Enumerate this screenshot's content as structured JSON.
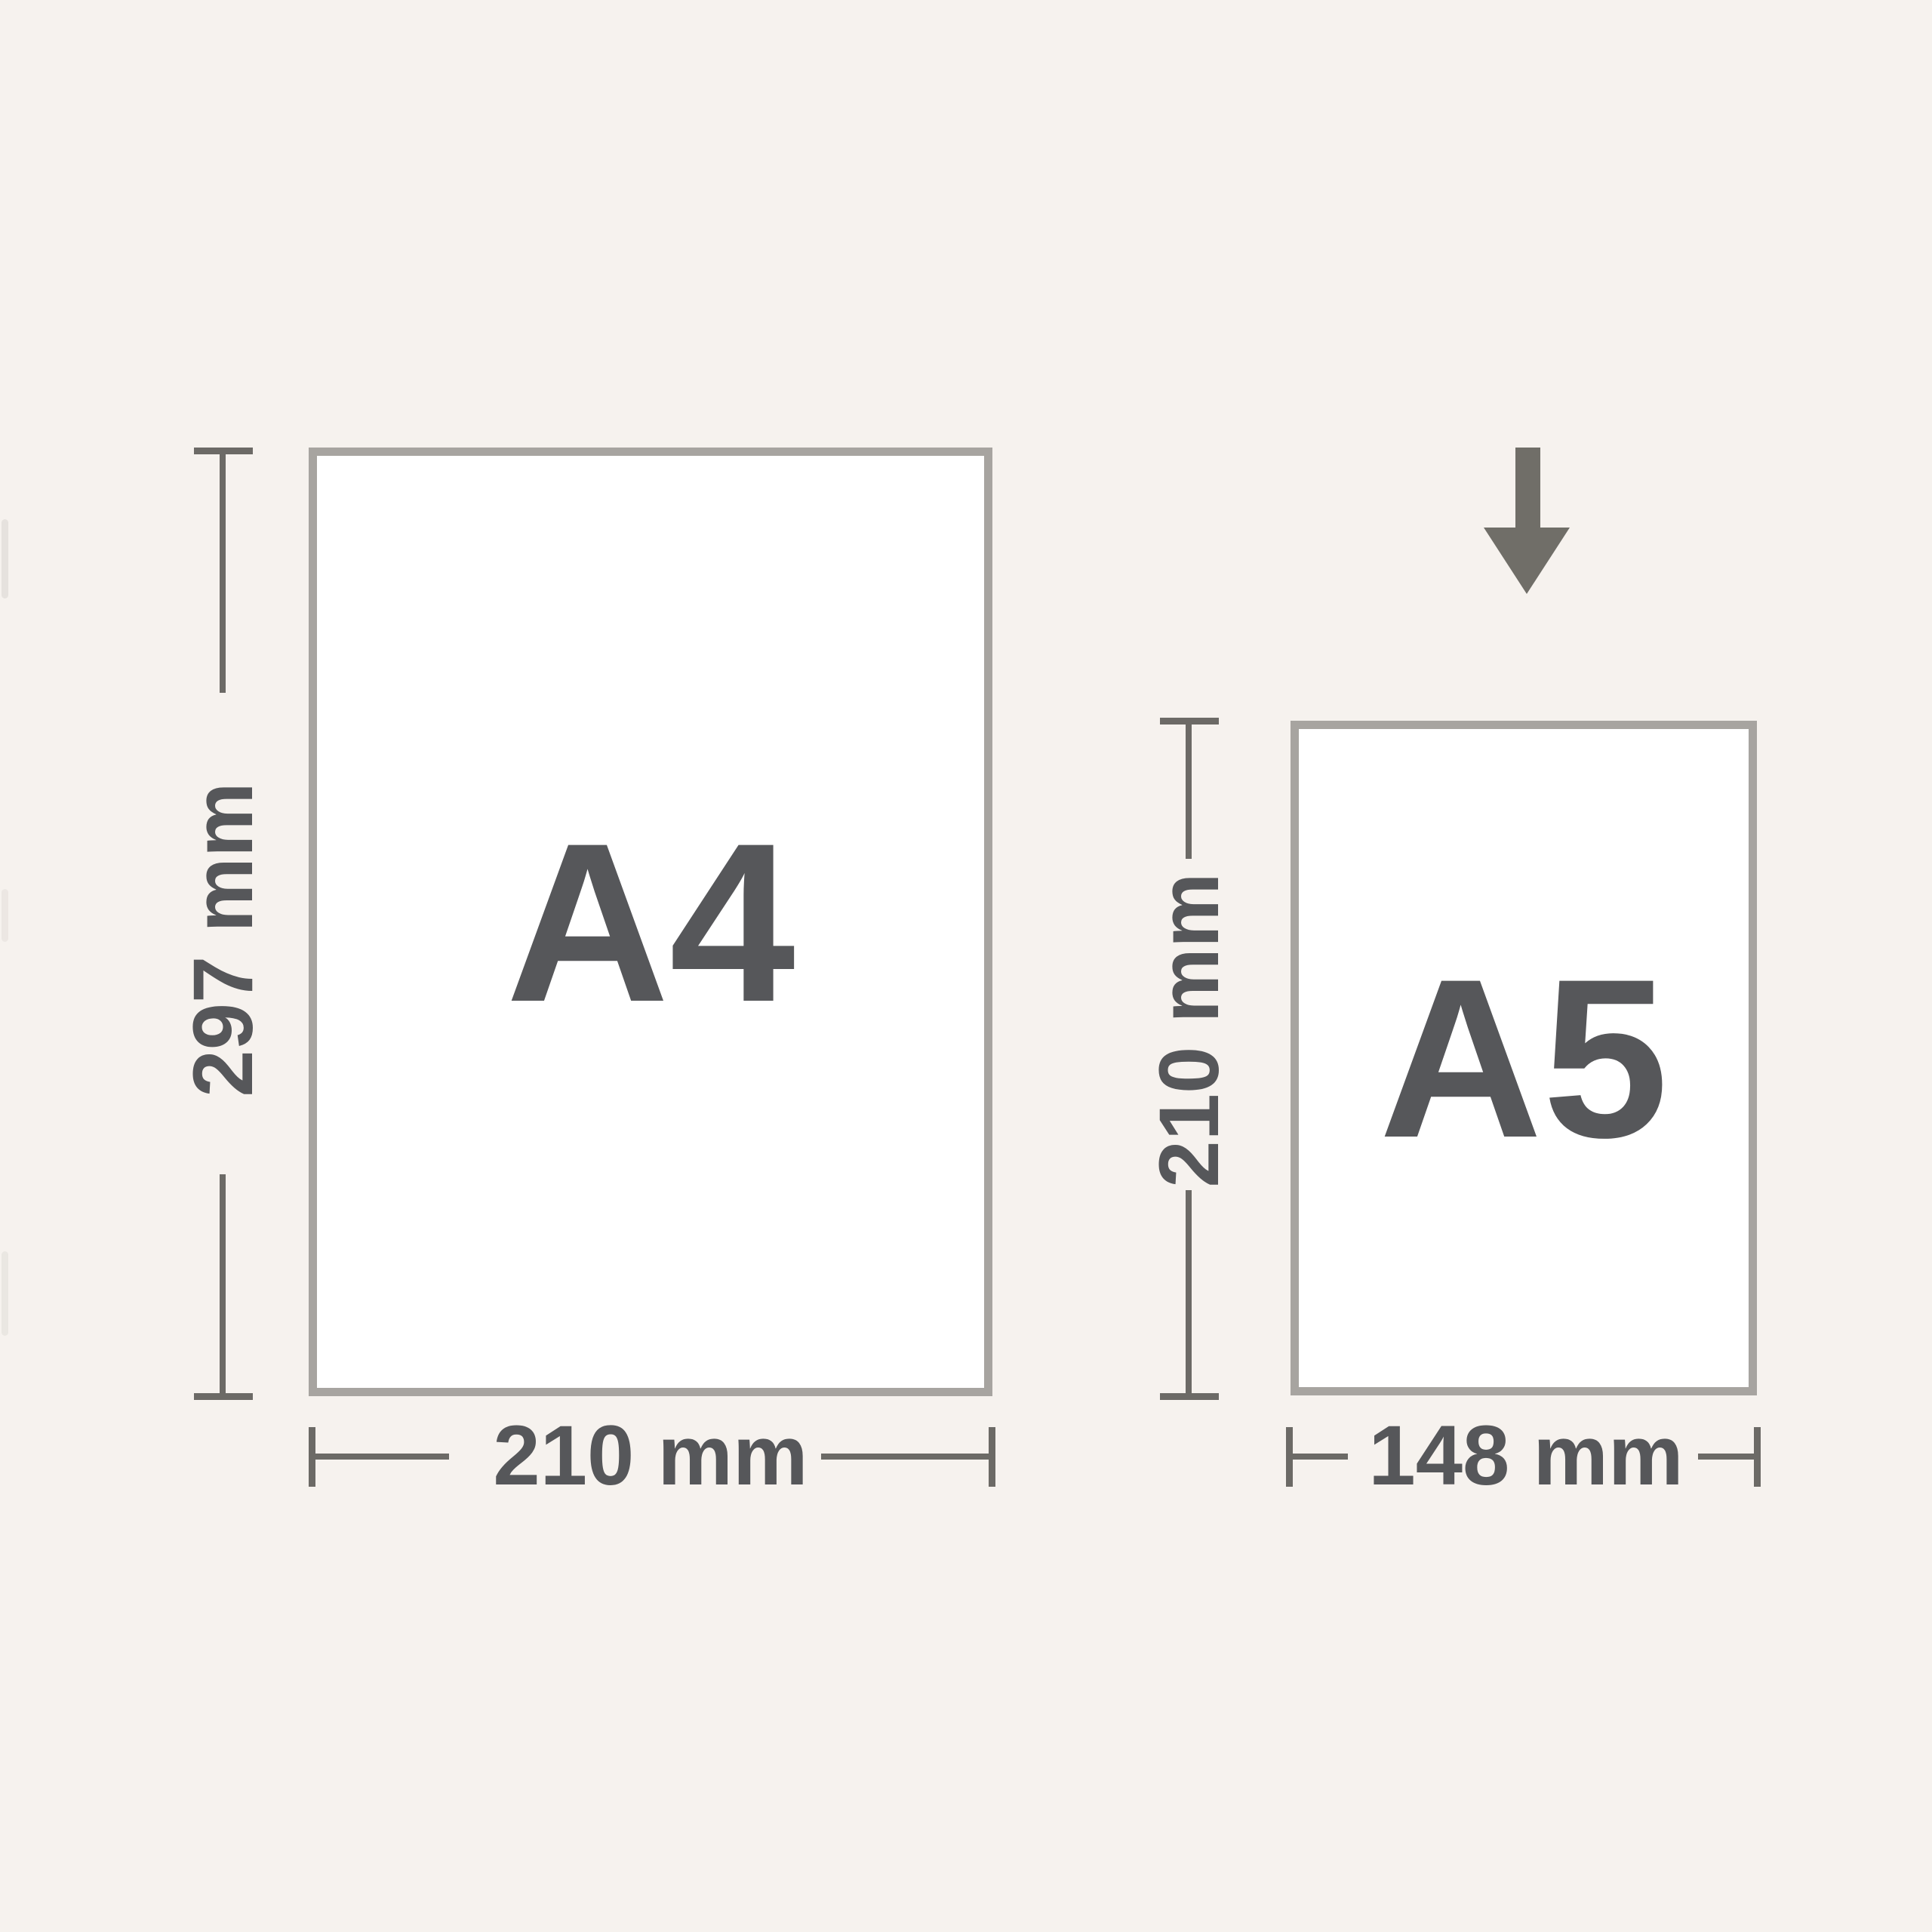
{
  "diagram": {
    "description": "Paper size comparison diagram showing A4 reduced to A5"
  },
  "papers": [
    {
      "name": "A4",
      "width_label": "210 mm",
      "height_label": "297 mm"
    },
    {
      "name": "A5",
      "width_label": "148 mm",
      "height_label": "210 mm"
    }
  ],
  "icons": {
    "arrow": "down-arrow"
  },
  "colors": {
    "background": "#f6f2ee",
    "paper_fill": "#ffffff",
    "paper_border": "#a7a4a0",
    "dimension_line": "#6c6a66",
    "text": "#56575a",
    "arrow": "#706e68"
  }
}
